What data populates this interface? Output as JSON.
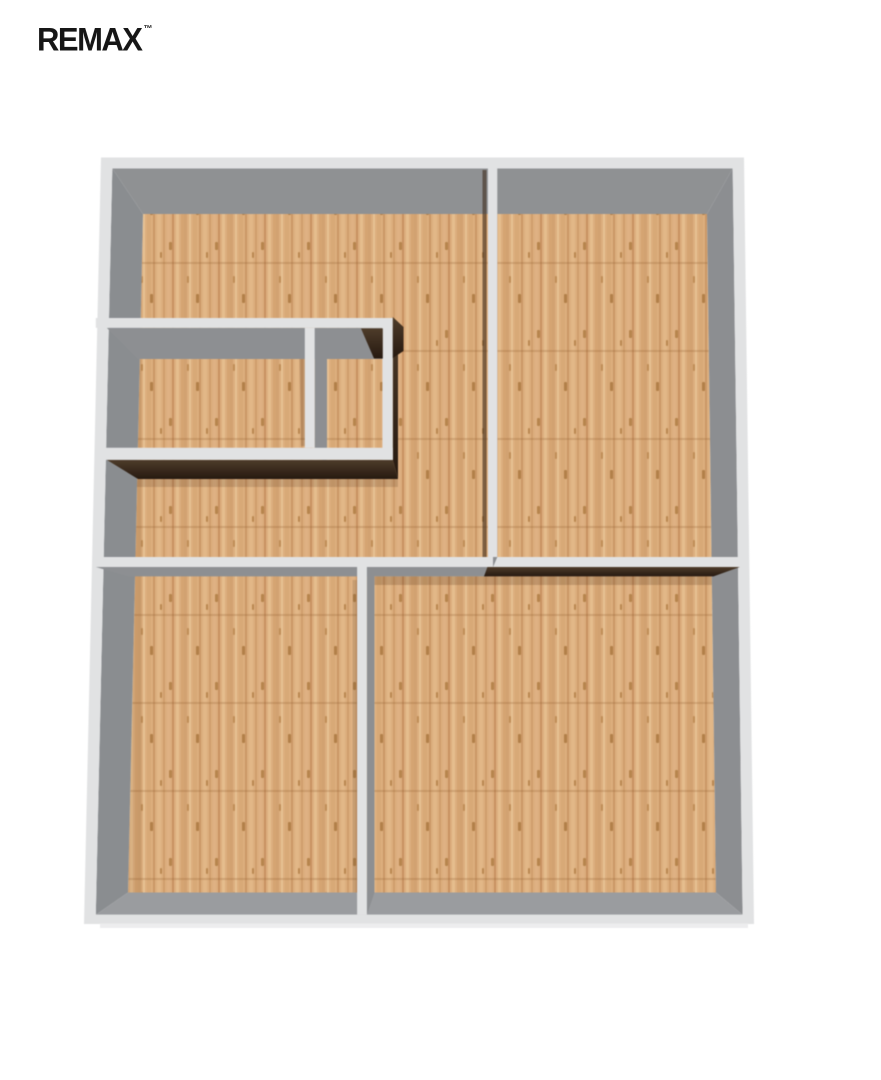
{
  "canvas": {
    "width": 881,
    "height": 1080,
    "background": "#ffffff"
  },
  "brand": {
    "logo_text": "REMAX",
    "trademark": "™",
    "logo_color": "#161616"
  },
  "floorplan": {
    "description_colors": {
      "cap": "#e1e2e3",
      "cap_edge_light": "#ededee",
      "face": "#8d8f92",
      "faceTop": "#8f9193",
      "faceLeft": "#8a8d90",
      "faceRight": "#8c8e91",
      "faceBottom": "#9a9c9f",
      "darkTop": "#4e3c2a",
      "darkBottom": "#261910",
      "darkFlat": "#3a2b1c",
      "floorBase": "#dcae7e"
    },
    "projection": {
      "vpx": 450,
      "vpy": 670,
      "k": 1.1
    },
    "frame": {
      "inner": [
        [
          143,
          214
        ],
        [
          707,
          214
        ],
        [
          716,
          892.5
        ],
        [
          128,
          892.5
        ]
      ],
      "outer": [
        [
          101,
          157.5
        ],
        [
          744,
          157.5
        ],
        [
          754,
          924
        ],
        [
          84,
          924
        ]
      ],
      "face_colors": [
        "faceTop",
        "faceRight",
        "faceBottom",
        "faceLeft"
      ]
    },
    "floor": {
      "quad": [
        [
          143,
          214
        ],
        [
          707,
          214
        ],
        [
          716,
          892.5
        ],
        [
          128,
          892.5
        ]
      ]
    },
    "wood": {
      "tile_w": 46,
      "tile_h": 88,
      "base": "#dcae7e",
      "streaks": [
        [
          0,
          3,
          "#d2a271"
        ],
        [
          5,
          2,
          "#e7c193"
        ],
        [
          9,
          4,
          "#d8a977"
        ],
        [
          15,
          2,
          "#cb9866"
        ],
        [
          19,
          4,
          "#e2b787"
        ],
        [
          25,
          2,
          "#d09e6c"
        ],
        [
          29,
          3,
          "#dfb183"
        ],
        [
          34,
          2,
          "#c79161"
        ],
        [
          38,
          3,
          "#e5bd8d"
        ],
        [
          43,
          3,
          "#d5a472"
        ]
      ],
      "knots": [
        [
          12,
          30,
          3,
          9,
          "#b28049"
        ],
        [
          31,
          66,
          3,
          8,
          "#b7854d"
        ],
        [
          3,
          12,
          2,
          7,
          "#bf8d57"
        ],
        [
          22,
          76,
          2,
          6,
          "#b98750"
        ]
      ],
      "seam": {
        "y": 86,
        "h": 2,
        "color": "rgba(150,100,55,0.28)"
      }
    },
    "walls": [
      {
        "name": "closet-north",
        "x1": 138,
        "y1": 350,
        "x2": 398,
        "y2": 359,
        "capX1": 128,
        "faces": {
          "south": "gray"
        }
      },
      {
        "name": "closet-divider",
        "x1": 318,
        "y1": 359,
        "x2": 327,
        "y2": 468,
        "faces": {
          "east": "gray"
        }
      },
      {
        "name": "closet-east",
        "x1": 388.5,
        "y1": 350,
        "x2": 398,
        "y2": 479,
        "faces": {
          "east": "dark"
        }
      },
      {
        "name": "closet-south",
        "x1": 138,
        "y1": 468,
        "x2": 398,
        "y2": 479,
        "capX1": 128,
        "faces": {
          "south": "dark"
        }
      },
      {
        "name": "mid-wall-west",
        "x1": 128,
        "y1": 567.3,
        "x2": 488,
        "y2": 576.4,
        "faces": {
          "south": "gray"
        }
      },
      {
        "name": "mid-wall-east",
        "x1": 484,
        "y1": 567.3,
        "x2": 713.5,
        "y2": 576.4,
        "faces": {
          "south": "dark"
        }
      },
      {
        "name": "top-divider",
        "x1": 484.5,
        "y1": 213.5,
        "x2": 493,
        "y2": 567.3,
        "faces": {
          "east": "gray"
        }
      },
      {
        "name": "bottom-divider",
        "x1": 365.5,
        "y1": 576.4,
        "x2": 374.5,
        "y2": 892.5,
        "faces": {
          "east": "gray"
        }
      }
    ],
    "shadows": [
      {
        "name": "floor-shadow-left-edge",
        "poly": [
          [
            130,
            214
          ],
          [
            142,
            214
          ],
          [
            142,
            892.5
          ],
          [
            128,
            892.5
          ]
        ],
        "fill": "rgba(120,80,40,0.10)"
      },
      {
        "name": "floor-shadow-closet-divider",
        "poly": [
          [
            299,
            334
          ],
          [
            305,
            334
          ],
          [
            305,
            446
          ],
          [
            301,
            446
          ]
        ],
        "fill": "rgba(60,40,20,0.18)"
      },
      {
        "name": "floor-shadow-bottom-divider",
        "poly": [
          [
            352.5,
            580
          ],
          [
            357,
            580
          ],
          [
            357,
            893
          ],
          [
            352.5,
            893
          ]
        ],
        "fill": "rgba(60,40,20,0.14)"
      },
      {
        "name": "floor-shadow-below-mid-east",
        "poly": [
          [
            374.5,
            576.5
          ],
          [
            713.5,
            576.5
          ],
          [
            713.5,
            585
          ],
          [
            374.5,
            585
          ]
        ],
        "fill": "rgba(80,50,25,0.22)"
      },
      {
        "name": "floor-shadow-below-closet",
        "poly": [
          [
            130,
            479
          ],
          [
            398,
            479
          ],
          [
            398,
            487
          ],
          [
            130,
            487
          ]
        ],
        "fill": "rgba(80,50,25,0.18)"
      }
    ],
    "overlays": [
      {
        "name": "shadow-top-divider-west",
        "poly": [
          [
            482.5,
            170
          ],
          [
            486.5,
            170
          ],
          [
            486.5,
            557
          ],
          [
            482.5,
            557
          ]
        ],
        "fill": "rgba(62,44,26,0.6)"
      }
    ],
    "accents": [
      {
        "name": "dark-corner-small-room",
        "poly": [
          [
            361,
            328.5
          ],
          [
            382.8,
            328.5
          ],
          [
            382.8,
            358.5
          ],
          [
            374,
            358.5
          ]
        ],
        "fill": "dark"
      },
      {
        "name": "dark-sliver-closet-east",
        "poly": [
          [
            392.8,
            317
          ],
          [
            403.5,
            327
          ],
          [
            403.5,
            351
          ],
          [
            392.8,
            358
          ]
        ],
        "fill": "dark"
      },
      {
        "name": "bottom-cap-outer-edge",
        "poly": [
          [
            100,
            923.5
          ],
          [
            748,
            923.5
          ],
          [
            748,
            928
          ],
          [
            100,
            928
          ]
        ],
        "fill": "#ededee"
      }
    ]
  }
}
